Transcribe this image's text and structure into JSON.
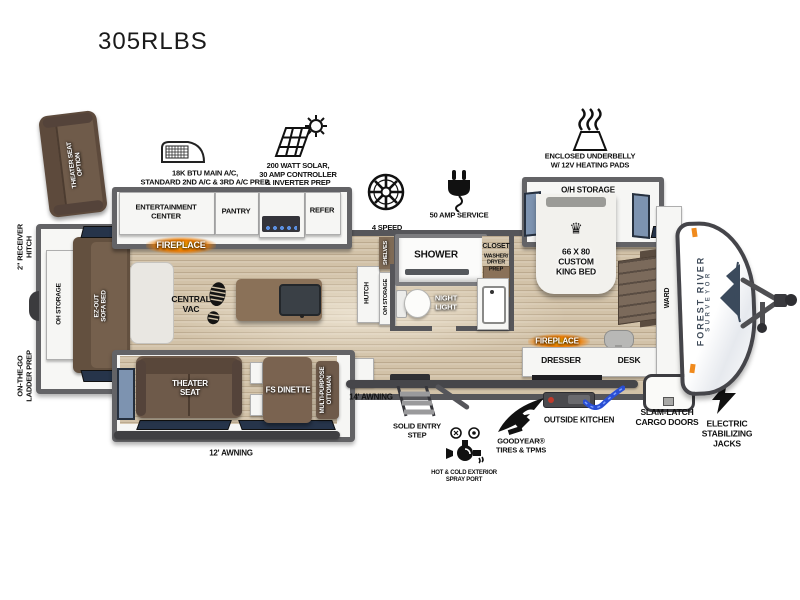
{
  "title": "305RLBS",
  "callouts": {
    "theater_seat_option": "THEATER SEAT\nOPTION",
    "main_ac": "18K BTU MAIN A/C,\nSTANDARD 2ND A/C & 3RD A/C PREP",
    "solar": "200 WATT SOLAR,\n30 AMP CONTROLLER\n& INVERTER PREP",
    "bath_fan": "4 SPEED\nHIGH POWERED\nBATH FAN",
    "amp_service": "50 AMP SERVICE",
    "underbelly": "ENCLOSED UNDERBELLY\nW/ 12V HEATING PADS",
    "receiver_hitch": "2\" RECEIVER\nHITCH",
    "ladder_prep": "ON-THE-GO\nLADDER PREP",
    "awning_12": "12' AWNING",
    "awning_14": "14' AWNING",
    "entry_step": "SOLID ENTRY\nSTEP",
    "spray_port": "HOT & COLD EXTERIOR\nSPRAY PORT",
    "goodyear": "GOODYEAR®\nTIRES & TPMS",
    "outside_kitchen": "OUTSIDE KITCHEN",
    "slam_latch": "SLAM-LATCH\nCARGO DOORS",
    "stab_jacks": "ELECTRIC\nSTABILIZING\nJACKS"
  },
  "rooms": {
    "oh_storage_rear": "OH STORAGE",
    "sofa_bed": "EZ-OUT\nSOFA BED",
    "entertainment_center": "ENTERTAINMENT\nCENTER",
    "pantry": "PANTRY",
    "refer": "REFER",
    "fireplace_living": "FIREPLACE",
    "central_vac": "CENTRAL\nVAC",
    "theater_seat": "THEATER\nSEAT",
    "fs_dinette": "FS DINETTE",
    "ottoman": "MULTI-PURPOSE\nOTTOMAN",
    "hutch": "HUTCH",
    "shelves": "SHELVES",
    "oh_storage_mid": "O/H STORAGE",
    "shower": "SHOWER",
    "night_light": "NIGHT\nLIGHT",
    "closet": "CLOSET",
    "closet_sub": "WASHER/\nDRYER\nPREP",
    "oh_storage_bed": "O/H STORAGE",
    "king_bed": "66 X 80\nCUSTOM\nKING BED",
    "fireplace_bed": "FIREPLACE",
    "dresser": "DRESSER",
    "desk": "DESK",
    "ward": "WARD",
    "brand_line1": "FOREST RIVER",
    "brand_line2": "SURVEYOR"
  },
  "icons": {
    "crown": "♛"
  },
  "colors": {
    "floor": "#d2c2a8",
    "wall": "#56565a",
    "furniture_brown": "#6e5a4a",
    "island_brown": "#8a7158",
    "window_blue": "#7d93b0",
    "fireplace_glow": "#f07d00",
    "awning_bar": "#3f3f42",
    "brand_navy": "#3f4b59",
    "marker_orange": "#f08a1d"
  }
}
